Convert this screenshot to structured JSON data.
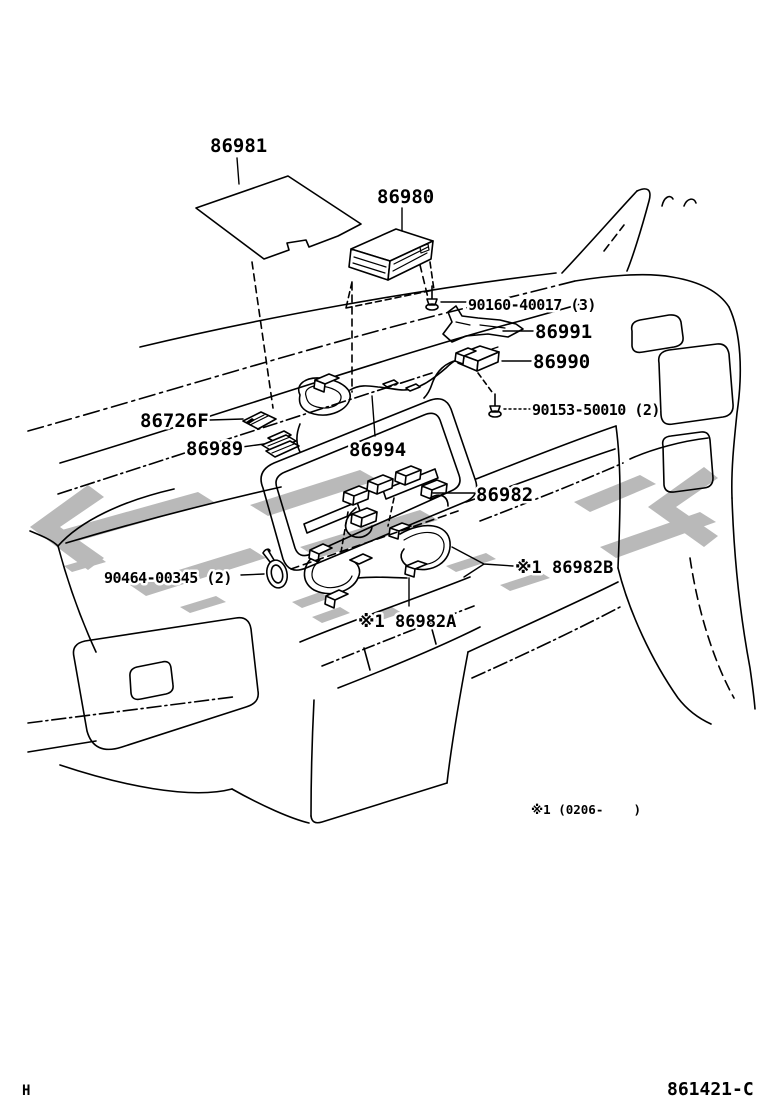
{
  "diagram": {
    "background": "#ffffff",
    "line_color": "#000000",
    "watermark_color": "#b9b9b9",
    "footnote": "※1 (0206-    )",
    "page_marker_left": "H",
    "drawing_number": "861421-C"
  },
  "labels": [
    {
      "id": "86981",
      "text": "86981"
    },
    {
      "id": "86980",
      "text": "86980"
    },
    {
      "id": "90160-40017",
      "text": "90160-40017 (3)"
    },
    {
      "id": "86991",
      "text": "86991"
    },
    {
      "id": "86990",
      "text": "86990"
    },
    {
      "id": "90153-50010",
      "text": "90153-50010 (2)"
    },
    {
      "id": "86726F",
      "text": "86726F"
    },
    {
      "id": "86989",
      "text": "86989"
    },
    {
      "id": "86994",
      "text": "86994"
    },
    {
      "id": "86982",
      "text": "86982"
    },
    {
      "id": "90464-00345",
      "text": "90464-00345 (2)"
    },
    {
      "id": "86982B",
      "text": "※1 86982B"
    },
    {
      "id": "86982A",
      "text": "※1 86982A"
    }
  ]
}
